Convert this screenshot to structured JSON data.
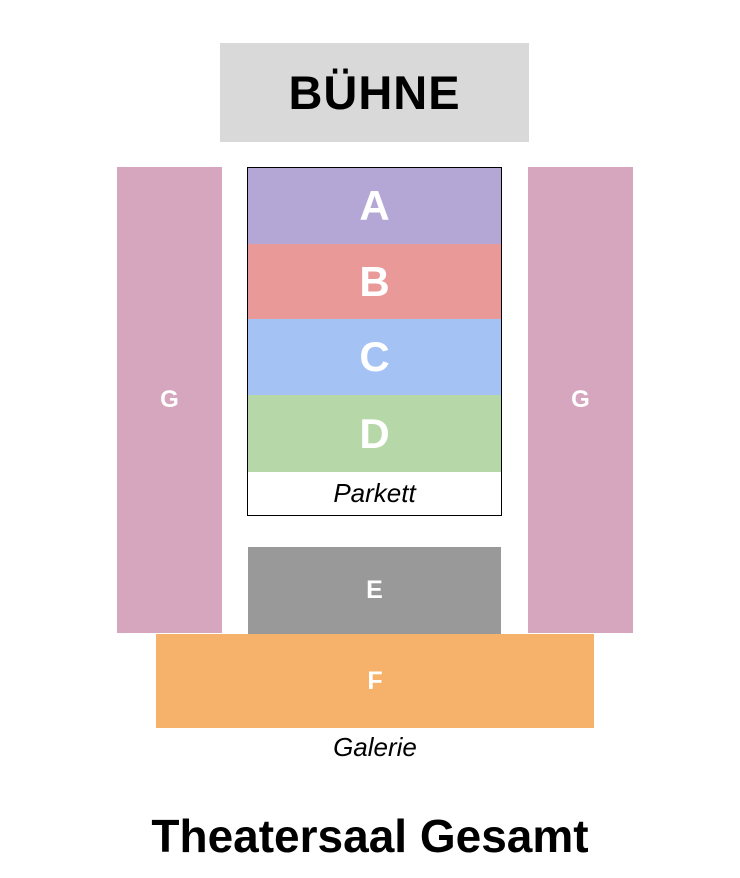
{
  "title": "Theatersaal Gesamt",
  "stage": {
    "label": "BÜHNE",
    "bg": "#d9d9d9"
  },
  "parkett": {
    "caption": "Parkett",
    "rows": [
      {
        "label": "A",
        "bg": "#b4a7d6"
      },
      {
        "label": "B",
        "bg": "#ea9999"
      },
      {
        "label": "C",
        "bg": "#a4c2f4"
      },
      {
        "label": "D",
        "bg": "#b6d7a8"
      }
    ]
  },
  "galerie": {
    "caption": "Galerie",
    "e": {
      "label": "E",
      "bg": "#999999"
    },
    "f": {
      "label": "F",
      "bg": "#f6b26b"
    },
    "g_left": {
      "label": "G",
      "bg": "#d5a6bd"
    },
    "g_right": {
      "label": "G",
      "bg": "#d5a6bd"
    }
  },
  "colors": {
    "section_text": "#ffffff",
    "text": "#000000",
    "background": "#ffffff",
    "parkett_border": "#000000"
  }
}
